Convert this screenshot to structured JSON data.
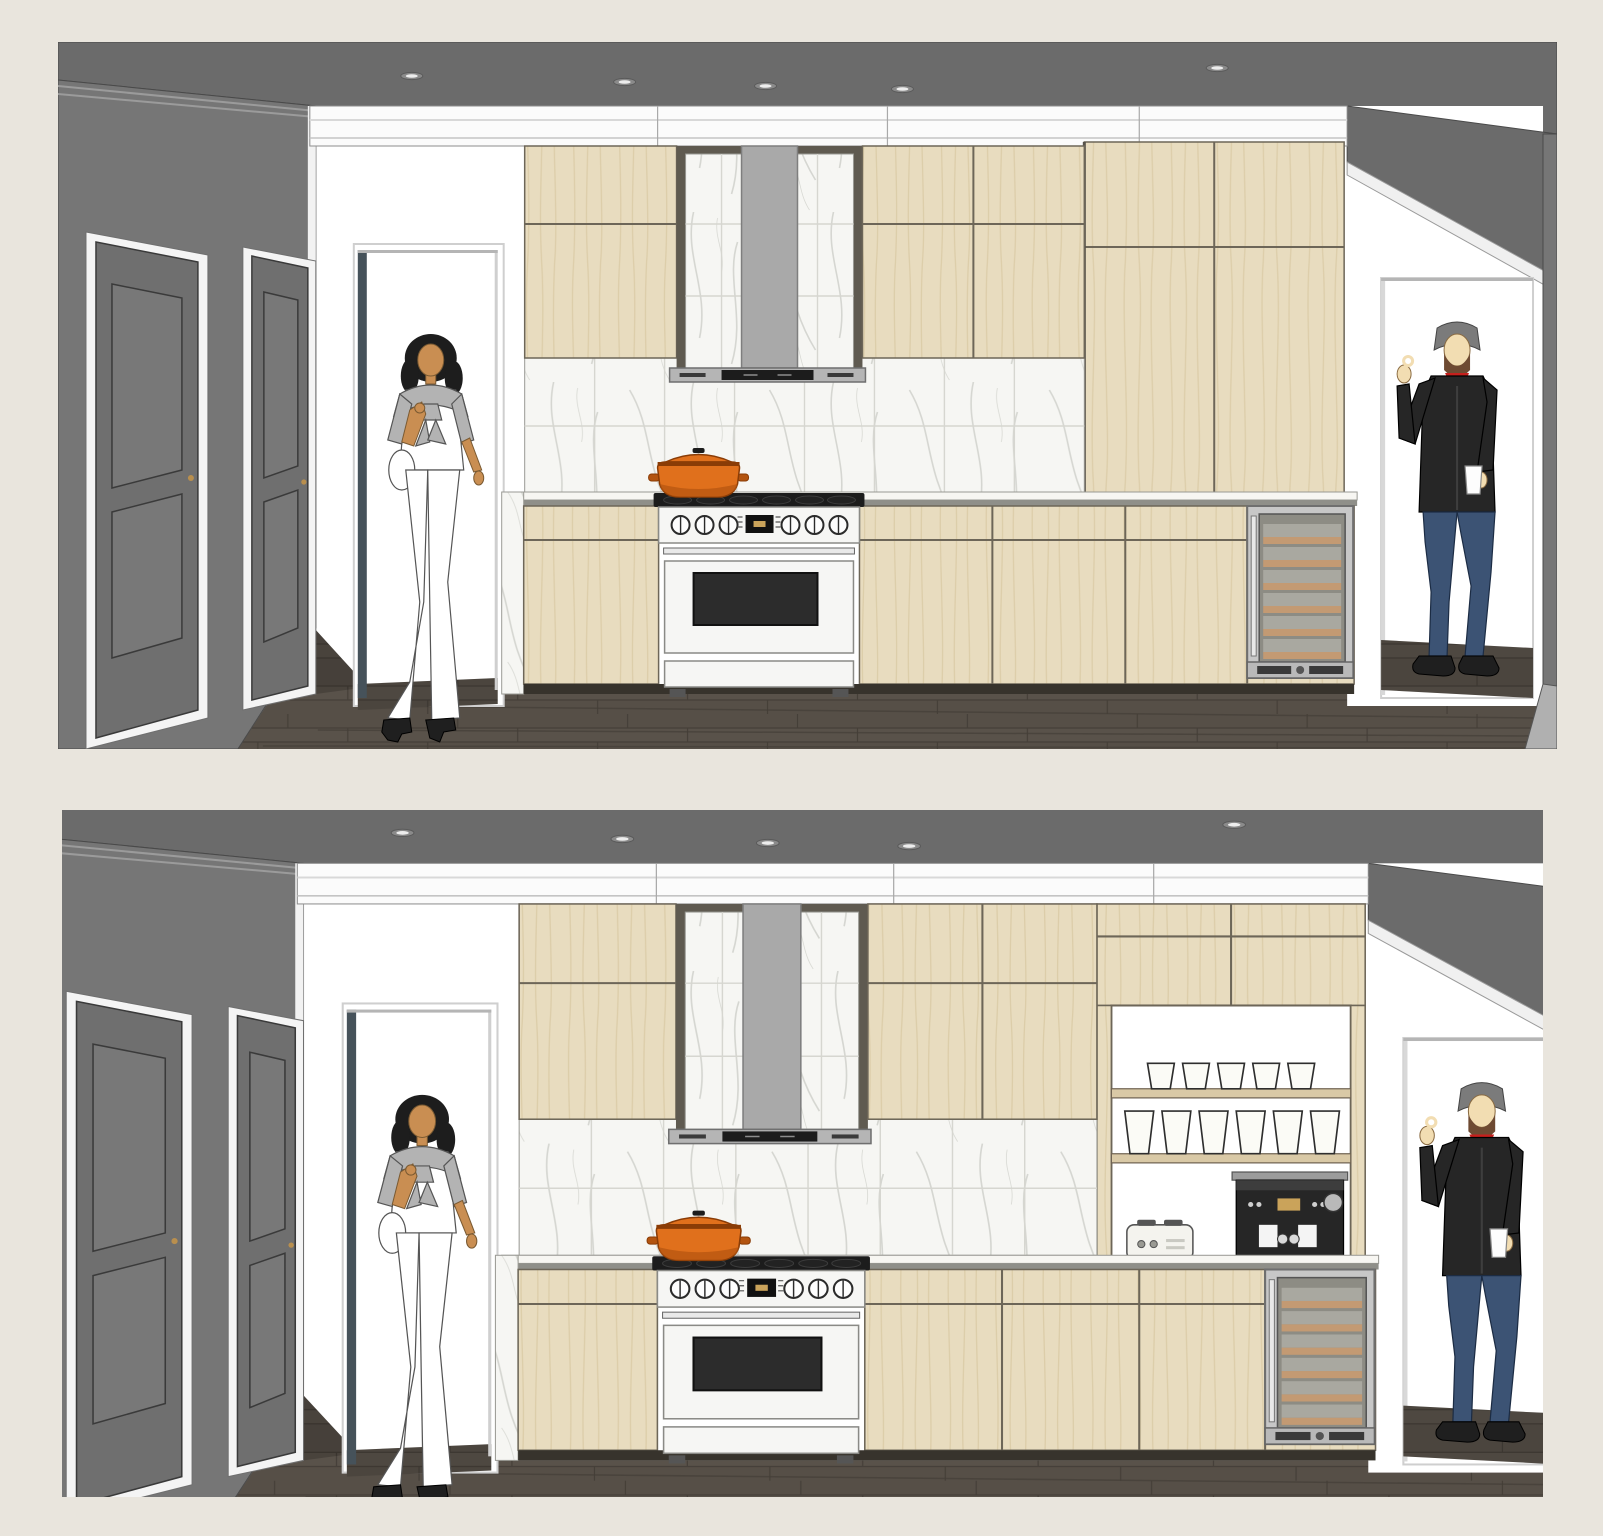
{
  "board": {
    "background": "#e9e5dd",
    "panel_count": 2
  },
  "panels": [
    {
      "id": "top",
      "variant": "closed-tall-cabinets",
      "objects": [
        "recessed-ceiling-lights",
        "dark-gray-side-wall",
        "paneled-interior-doors",
        "doorway-opening-left",
        "woman-figure",
        "crown-molding",
        "upper-cabinets",
        "hood-niche-marble-tile",
        "chimney-range-hood",
        "marble-backsplash",
        "white-gas-range",
        "orange-dutch-oven-pot",
        "tall-closed-cabinets",
        "stone-countertop",
        "base-cabinets",
        "under-counter-wine-cooler",
        "doorway-opening-right",
        "man-figure-with-coffee-cup",
        "dark-wood-plank-floor"
      ],
      "range_knob_count": 6,
      "wine_cooler_shelf_count": 6
    },
    {
      "id": "bottom",
      "variant": "open-shelving-coffee-station",
      "objects": [
        "recessed-ceiling-lights",
        "dark-gray-side-wall",
        "paneled-interior-doors",
        "doorway-opening-left",
        "woman-figure",
        "crown-molding",
        "upper-cabinets",
        "hood-niche-marble-tile",
        "chimney-range-hood",
        "marble-backsplash",
        "white-gas-range",
        "orange-dutch-oven-pot",
        "open-shelf-niche",
        "drinking-glasses",
        "four-slice-toaster",
        "espresso-machine",
        "stone-countertop",
        "base-cabinets",
        "under-counter-wine-cooler",
        "doorway-opening-right",
        "man-figure-with-coffee-cup",
        "dark-wood-plank-floor"
      ],
      "glasses_top_shelf": 5,
      "glasses_bottom_shelf": 6,
      "range_knob_count": 6,
      "wine_cooler_shelf_count": 6
    }
  ],
  "figures": [
    {
      "name": "woman",
      "hair": "#1d1d1d",
      "skin": "#c98e52",
      "outfit": "white-top-white-pants-gray-sweater-tied",
      "shoes": "#1f1f1f"
    },
    {
      "name": "man",
      "hair": "#7b7b7b",
      "beard": "#6e4a32",
      "skin": "#f2ddb2",
      "outfit": "black-jacket-red-shirt-blue-jeans",
      "holding": "white-coffee-cup"
    }
  ],
  "palette": {
    "bg": "#e9e5dd",
    "ceiling": "#6b6b6b",
    "wallDark": "#767676",
    "doorFace": "#6f6f6f",
    "doorTrim": "#f4f4f4",
    "crown": "#fbfbfb",
    "cabinet": "#e8dcbf",
    "cabinetGrain": "#d9c9a4",
    "marble": "#f6f6f3",
    "marbleVein": "#b9bcb4",
    "counter": "#f7f6f2",
    "counterEdge": "#8f8f89",
    "hoodChimney": "#a9a9a9",
    "rangeWhite": "#f6f6f4",
    "ovenGlass": "#2c2c2c",
    "pot": "#e0701c",
    "potDark": "#b35410",
    "floor": "#564f47",
    "floorDark": "#453f38",
    "floorLight": "#6a6158",
    "fridgeInner": "#8d8c84",
    "fridgeShelf": "#c39a73",
    "shelfWood": "#d9c9a6",
    "glass": "#fbfbf6",
    "applianceDark": "#262626",
    "skinWoman": "#c98e52",
    "hairWoman": "#1d1d1d",
    "sweater": "#b3b3b3",
    "skinMan": "#f2ddb2",
    "hairMan": "#7b7b7b",
    "beard": "#6e4a32",
    "jacket": "#262626",
    "shirtRed": "#c6201d",
    "jeans": "#3c5374",
    "shoe": "#1f1f1f",
    "jamb": "#46525a"
  }
}
